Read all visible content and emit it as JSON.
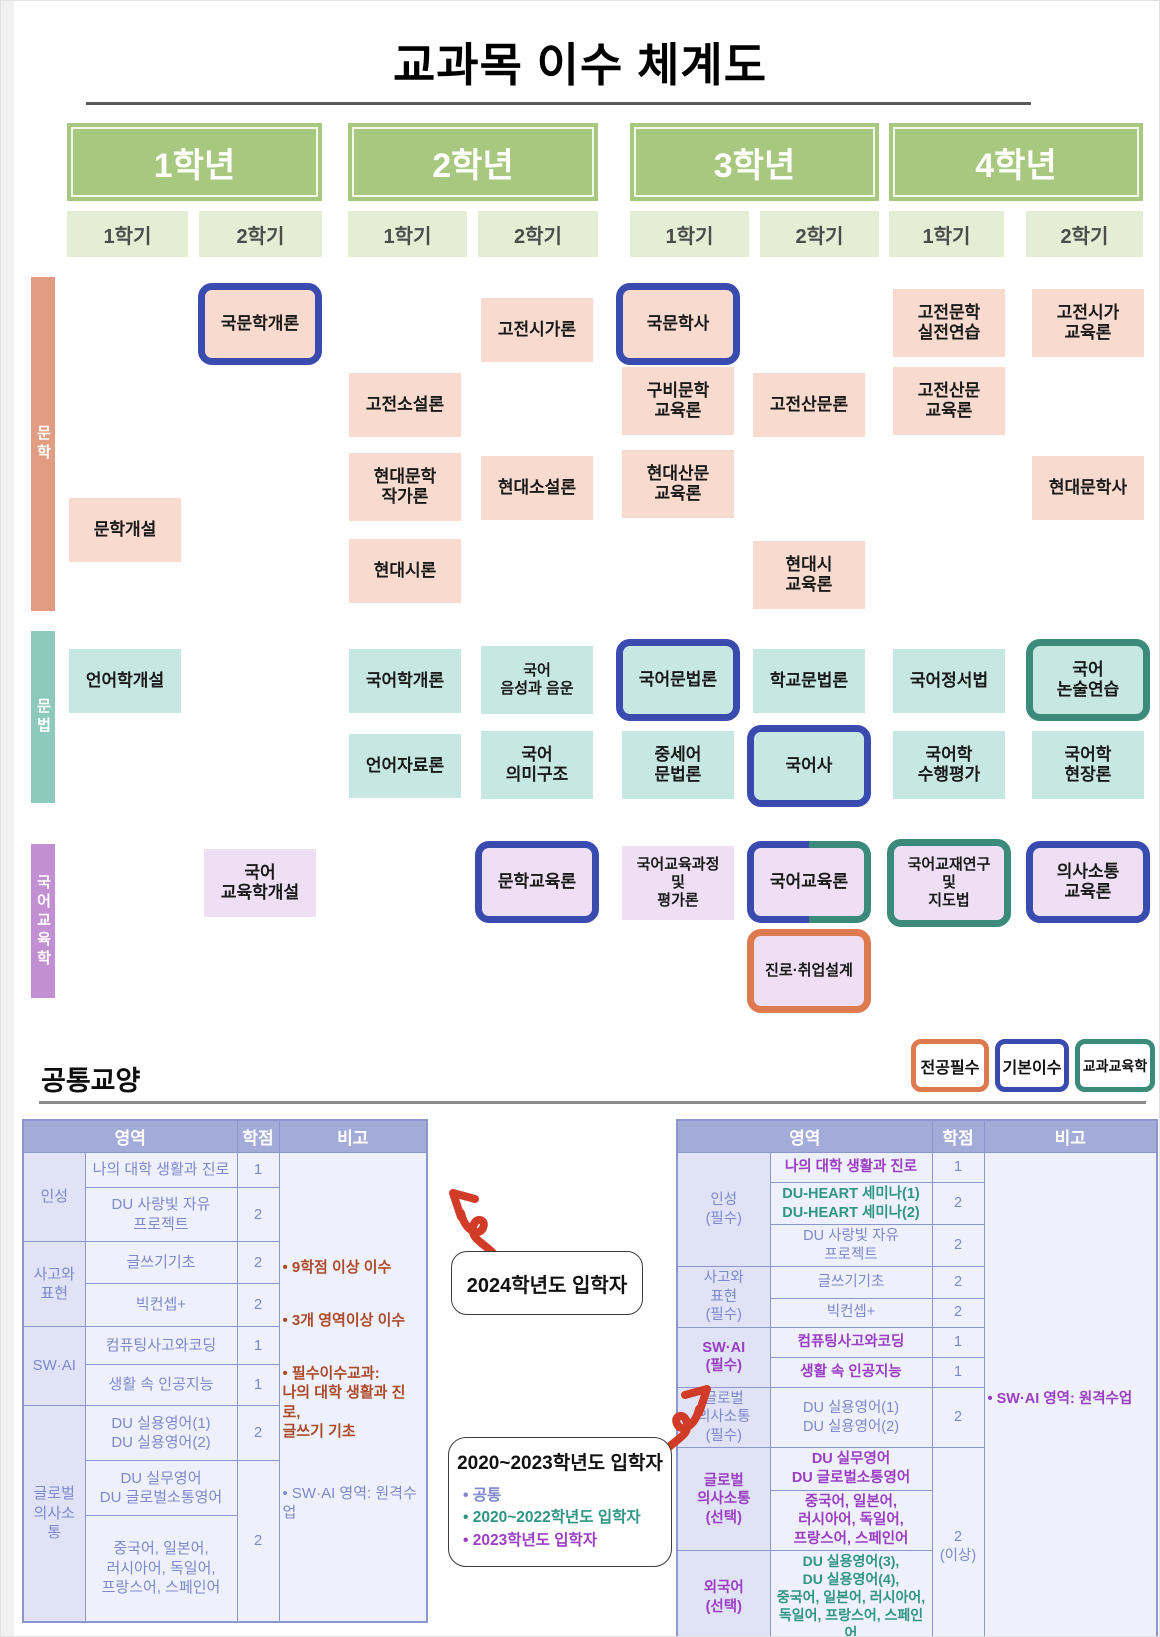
{
  "title": "교과목 이수 체계도",
  "years": [
    {
      "label": "1학년",
      "sem1": "1학기",
      "sem2": "2학기"
    },
    {
      "label": "2학년",
      "sem1": "1학기",
      "sem2": "2학기"
    },
    {
      "label": "3학년",
      "sem1": "1학기",
      "sem2": "2학기"
    },
    {
      "label": "4학년",
      "sem1": "1학기",
      "sem2": "2학기"
    }
  ],
  "tracks": {
    "literature": "문학",
    "grammar": "문법",
    "education": "국어교육학"
  },
  "courses": {
    "munhak_gaeseol": "문학개설",
    "gukmunhak_gaeron": "국문학개론",
    "gojeon_soseolron": "고전소설론",
    "hyundae_munhak_jakgaron": "현대문학\n작가론",
    "hyundae_siron": "현대시론",
    "gojeon_sigaron": "고전시가론",
    "hyundae_soseolron": "현대소설론",
    "gukmunhaksa": "국문학사",
    "gubimunhak_gyoyukron": "구비문학\n교육론",
    "hyundae_sanmun_gyoyukron": "현대산문\n교육론",
    "gojeon_sanmunron": "고전산문론",
    "hyundae_si_gyoyukron": "현대시\n교육론",
    "gojeonmunhak_siljeon": "고전문학\n실전연습",
    "gojeon_sanmun_gyoyukron": "고전산문\n교육론",
    "gojeon_siga_gyoyukron": "고전시가\n교육론",
    "hyundae_munhaksa": "현대문학사",
    "eoneohak_gaeseol": "언어학개설",
    "gukeohak_gaeron": "국어학개론",
    "eoneo_jaryoron": "언어자료론",
    "gukeo_eumseong_eumun": "국어\n음성과 음운",
    "gukeo_uimigujo": "국어\n의미구조",
    "gukeo_munbeopron": "국어문법론",
    "jungseeo_munbeopron": "중세어\n문법론",
    "hakgyo_munbeopron": "학교문법론",
    "gukeosa": "국어사",
    "gukeo_jeongseobeop": "국어정서법",
    "gukeohak_suhaeng_pyeongga": "국어학\n수행평가",
    "gukeo_nonsul_yeonseup": "국어\n논술연습",
    "gukeohak_hyeonjangron": "국어학\n현장론",
    "gukeo_gyoyukhak_gaeseol": "국어\n교육학개설",
    "munhak_gyoyukron": "문학교육론",
    "gukeo_gyoyuk_gwajeong": "국어교육과정\n및\n평가론",
    "gukeo_gyoyukron": "국어교육론",
    "gukeo_gyojae_yeongu": "국어교재연구\n및\n지도법",
    "uisasotong_gyoyukron": "의사소통\n교육론",
    "jinro_chwieop_seolgye": "진로·취업설계"
  },
  "legend": {
    "major_required": "전공필수",
    "basic_completion": "기본이수",
    "subject_pedagogy": "교과교육학"
  },
  "common": {
    "title": "공통교양",
    "headers": {
      "area": "영역",
      "credit": "학점",
      "note": "비고"
    },
    "left": {
      "cats": [
        "인성",
        "사고와\n표현",
        "SW·AI",
        "글로벌\n의사소통"
      ],
      "rows": [
        {
          "c": "나의 대학 생활과 진로",
          "p": "1"
        },
        {
          "c": "DU 사랑빛 자유\n프로젝트",
          "p": "2"
        },
        {
          "c": "글쓰기기초",
          "p": "2"
        },
        {
          "c": "빅컨셉+",
          "p": "2"
        },
        {
          "c": "컴퓨팅사고와코딩",
          "p": "1"
        },
        {
          "c": "생활 속 인공지능",
          "p": "1"
        },
        {
          "c": "DU 실용영어(1)\nDU 실용영어(2)",
          "p": "2"
        },
        {
          "c": "DU 실무영어\nDU 글로벌소통영어",
          "p": "2"
        },
        {
          "c": "중국어, 일본어,\n러시아어, 독일어,\n프랑스어, 스페인어"
        }
      ],
      "notes": [
        "• 9학점 이상 이수",
        "• 3개 영역이상 이수",
        "• 필수이수교과:\n나의 대학 생활과 진로,\n글쓰기 기초",
        "• SW·AI 영역: 원격수업"
      ]
    },
    "right": {
      "cats": [
        "인성\n(필수)",
        "사고와\n표현\n(필수)",
        "SW·AI\n(필수)",
        "글로벌\n의사소통\n(필수)",
        "글로벌\n의사소통\n(선택)",
        "외국어\n(선택)"
      ],
      "rows": [
        {
          "c": "나의 대학 생활과 진로",
          "p": "1"
        },
        {
          "c": "DU-HEART 세미나(1)\nDU-HEART 세미나(2)",
          "p": "2"
        },
        {
          "c": "DU 사랑빛 자유\n프로젝트",
          "p": "2"
        },
        {
          "c": "글쓰기기초",
          "p": "2"
        },
        {
          "c": "빅컨셉+",
          "p": "2"
        },
        {
          "c": "컴퓨팅사고와코딩",
          "p": "1"
        },
        {
          "c": "생활 속 인공지능",
          "p": "1"
        },
        {
          "c": "DU 실용영어(1)\nDU 실용영어(2)",
          "p": "2"
        },
        {
          "c": "DU 실무영어\nDU 글로벌소통영어"
        },
        {
          "c": "중국어, 일본어,\n러시아어, 독일어,\n프랑스어, 스페인어",
          "p": "2\n(이상)"
        },
        {
          "c": "DU 실용영어(3),\nDU 실용영어(4),\n중국어, 일본어, 러시아어,\n독일어, 프랑스어, 스페인어"
        }
      ],
      "note": "• SW·AI 영역: 원격수업"
    },
    "callouts": {
      "c2024": "2024학년도 입학자",
      "c2020": "2020~2023학년도 입학자",
      "b_common": "• 공통",
      "b_2020_2022": "• 2020~2022학년도 입학자",
      "b_2023": "• 2023학년도 입학자"
    }
  }
}
